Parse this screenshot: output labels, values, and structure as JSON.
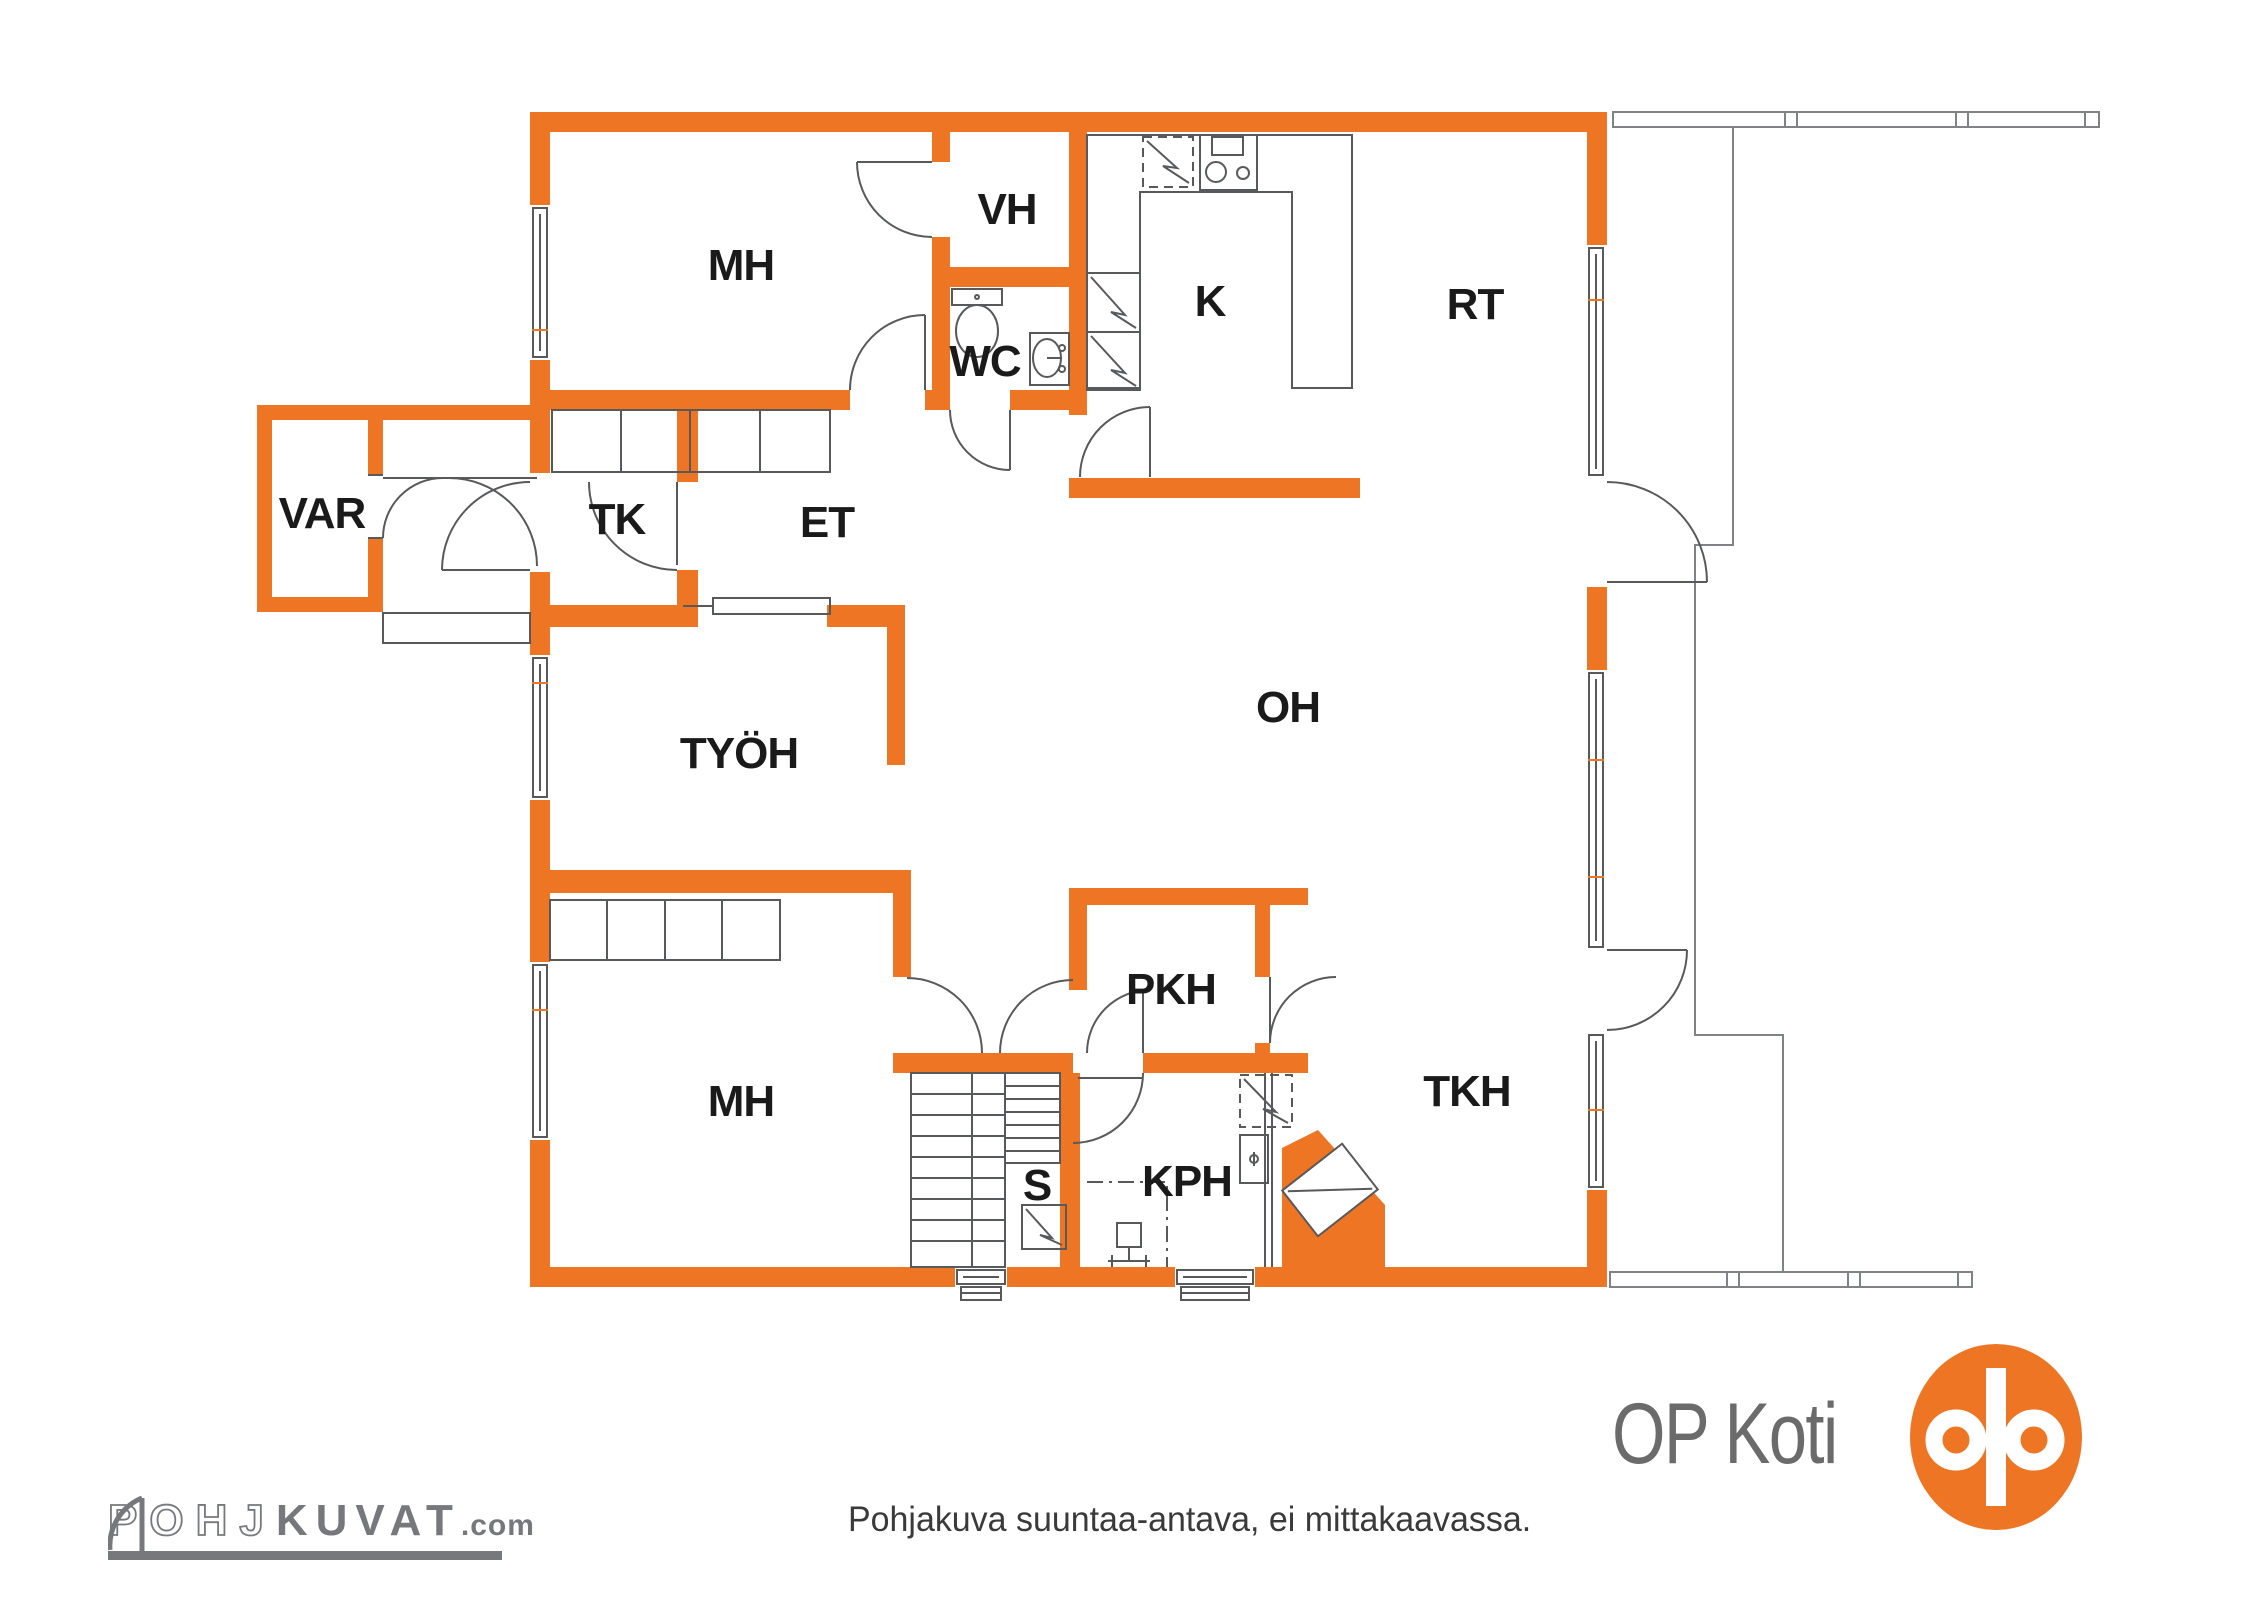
{
  "plan": {
    "rooms": {
      "mh_top": {
        "label": "MH"
      },
      "vh": {
        "label": "VH"
      },
      "wc": {
        "label": "WC"
      },
      "k": {
        "label": "K"
      },
      "rt": {
        "label": "RT"
      },
      "var": {
        "label": "VAR"
      },
      "tk": {
        "label": "TK"
      },
      "et": {
        "label": "ET"
      },
      "tyoh": {
        "label": "TYÖH"
      },
      "oh": {
        "label": "OH"
      },
      "pkh": {
        "label": "PKH"
      },
      "mh_bottom": {
        "label": "MH"
      },
      "tkh": {
        "label": "TKH"
      },
      "s": {
        "label": "S"
      },
      "kph": {
        "label": "KPH"
      }
    },
    "icons": [
      "door-arc-icon",
      "window-icon",
      "toilet-icon",
      "sink-icon",
      "stove-icon",
      "fridge-icon",
      "sauna-stove-icon",
      "stairs-icon",
      "shower-icon",
      "washer-icon",
      "fireplace-icon",
      "sliding-door-icon",
      "closet-icon",
      "deck-railing-icon"
    ],
    "colors": {
      "wall_orange": "#EE7523",
      "line_gray": "#58595b",
      "logo_gray": "#77787b",
      "text_dark": "#3a3a3a"
    }
  },
  "footer": {
    "disclaimer": "Pohjakuva suuntaa-antava, ei mittakaavassa."
  },
  "branding": {
    "left": {
      "part1": "POHJ",
      "part2": "KUVAT",
      "part3": ".com"
    },
    "right": {
      "wordmark": "OP Koti"
    }
  }
}
